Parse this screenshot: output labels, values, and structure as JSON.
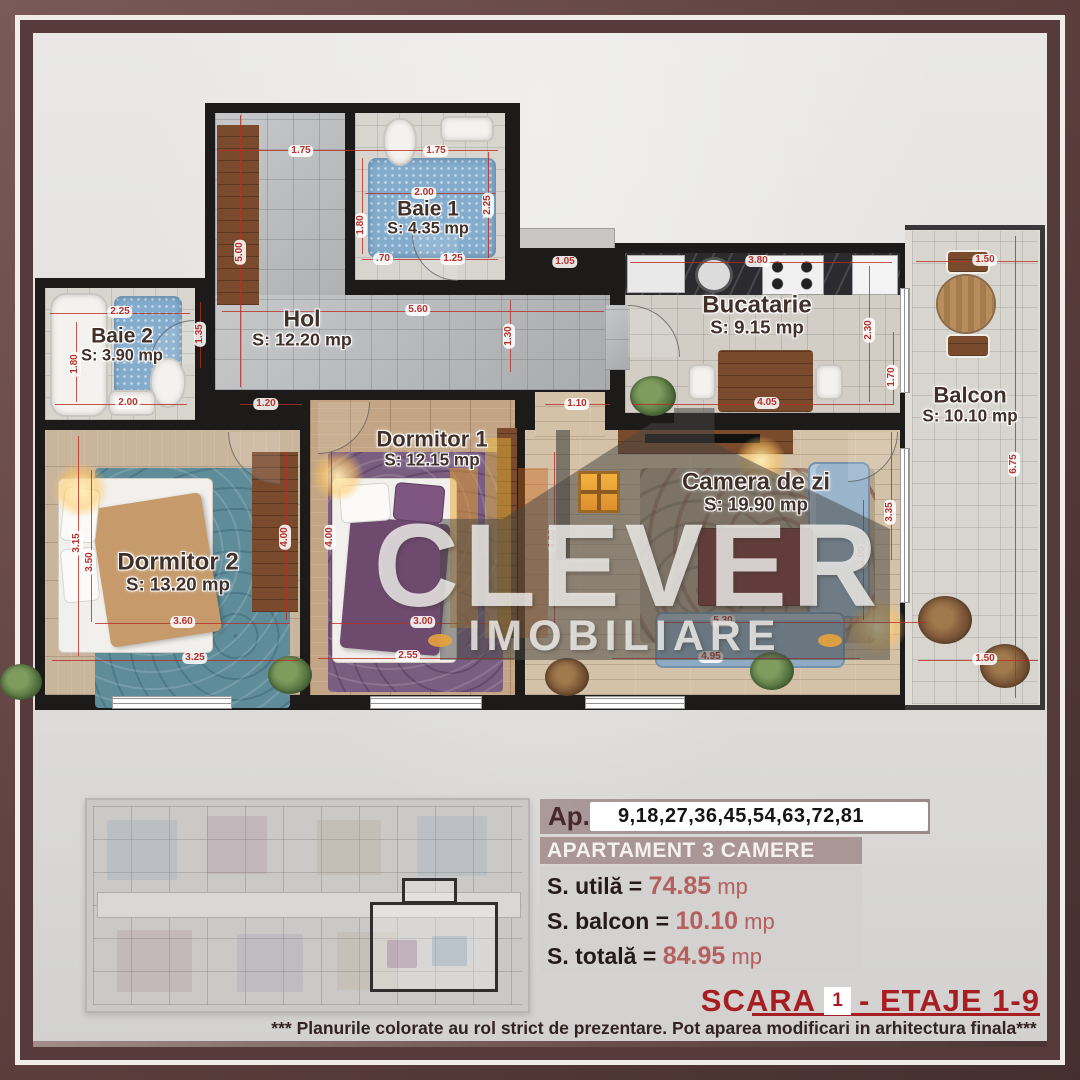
{
  "brand": {
    "name": "CLEVER",
    "tagline": "IMOBILIARE"
  },
  "plan": {
    "rooms": [
      {
        "id": "baie1",
        "name": "Baie 1",
        "area": "S: 4.35 mp",
        "x": 428,
        "y": 218,
        "fs": 21
      },
      {
        "id": "baie2",
        "name": "Baie 2",
        "area": "S: 3.90 mp",
        "x": 122,
        "y": 345,
        "fs": 21
      },
      {
        "id": "hol",
        "name": "Hol",
        "area": "S: 12.20 mp",
        "x": 302,
        "y": 328,
        "fs": 23
      },
      {
        "id": "bucatarie",
        "name": "Bucatarie",
        "area": "S: 9.15 mp",
        "x": 757,
        "y": 315,
        "fs": 24
      },
      {
        "id": "balcon",
        "name": "Balcon",
        "area": "S: 10.10 mp",
        "x": 970,
        "y": 404,
        "fs": 22
      },
      {
        "id": "dormitor1",
        "name": "Dormitor 1",
        "area": "S: 12.15 mp",
        "x": 432,
        "y": 448,
        "fs": 22
      },
      {
        "id": "dormitor2",
        "name": "Dormitor 2",
        "area": "S: 13.20 mp",
        "x": 178,
        "y": 572,
        "fs": 24
      },
      {
        "id": "camera-de-zi",
        "name": "Camera de zi",
        "area": "S: 19.90 mp",
        "x": 756,
        "y": 492,
        "fs": 24
      }
    ],
    "dimensions": [
      {
        "t": "1.75",
        "x": 301,
        "y": 151
      },
      {
        "t": "1.75",
        "x": 436,
        "y": 151
      },
      {
        "t": "2.00",
        "x": 424,
        "y": 193
      },
      {
        "t": "2.25",
        "x": 488,
        "y": 205,
        "v": 1
      },
      {
        "t": "1.80",
        "x": 361,
        "y": 225,
        "v": 1
      },
      {
        "t": ".70",
        "x": 383,
        "y": 259
      },
      {
        "t": "1.25",
        "x": 453,
        "y": 259
      },
      {
        "t": "5.00",
        "x": 240,
        "y": 252,
        "v": 1
      },
      {
        "t": "2.25",
        "x": 120,
        "y": 312
      },
      {
        "t": "1.35",
        "x": 200,
        "y": 334,
        "v": 1
      },
      {
        "t": "1.80",
        "x": 75,
        "y": 364,
        "v": 1
      },
      {
        "t": "2.00",
        "x": 128,
        "y": 403
      },
      {
        "t": "5.60",
        "x": 418,
        "y": 310
      },
      {
        "t": "1.30",
        "x": 509,
        "y": 336,
        "v": 1
      },
      {
        "t": "1.05",
        "x": 565,
        "y": 262
      },
      {
        "t": "3.80",
        "x": 758,
        "y": 261
      },
      {
        "t": "2.30",
        "x": 869,
        "y": 330,
        "v": 1
      },
      {
        "t": "1.70",
        "x": 892,
        "y": 377,
        "v": 1
      },
      {
        "t": "4.05",
        "x": 767,
        "y": 403
      },
      {
        "t": "1.50",
        "x": 985,
        "y": 260
      },
      {
        "t": "6.75",
        "x": 1014,
        "y": 464,
        "v": 1
      },
      {
        "t": "1.50",
        "x": 985,
        "y": 659
      },
      {
        "t": "1.20",
        "x": 266,
        "y": 404
      },
      {
        "t": "1.10",
        "x": 577,
        "y": 404
      },
      {
        "t": "3.15",
        "x": 77,
        "y": 543,
        "v": 1
      },
      {
        "t": "3.50",
        "x": 90,
        "y": 562,
        "v": 1
      },
      {
        "t": "4.00",
        "x": 285,
        "y": 537,
        "v": 1
      },
      {
        "t": "4.00",
        "x": 330,
        "y": 537,
        "v": 1
      },
      {
        "t": "4.00",
        "x": 553,
        "y": 539,
        "v": 1
      },
      {
        "t": "3.60",
        "x": 183,
        "y": 622
      },
      {
        "t": "3.25",
        "x": 195,
        "y": 658
      },
      {
        "t": "3.00",
        "x": 423,
        "y": 622
      },
      {
        "t": "2.55",
        "x": 408,
        "y": 656
      },
      {
        "t": "5.30",
        "x": 723,
        "y": 621
      },
      {
        "t": "4.95",
        "x": 711,
        "y": 657
      },
      {
        "t": "3.35",
        "x": 890,
        "y": 512,
        "v": 1
      },
      {
        "t": "3.00",
        "x": 862,
        "y": 556,
        "v": 1
      }
    ]
  },
  "info_panel": {
    "ap_label": "Ap.",
    "ap_numbers": "9,18,27,36,45,54,63,72,81",
    "type_label": "APARTAMENT 3 CAMERE",
    "rows": [
      {
        "label": "S. utilă = ",
        "value": "74.85",
        "unit": " mp"
      },
      {
        "label": "S. balcon = ",
        "value": "10.10",
        "unit": " mp"
      },
      {
        "label": "S. totală = ",
        "value": "84.95",
        "unit": " mp"
      }
    ]
  },
  "footer": {
    "scara_label": "SCARA",
    "scara_number": "1",
    "etaje_label": "- ETAJE 1-9",
    "disclaimer": "*** Planurile colorate au rol strict de prezentare. Pot aparea modificari in arhitectura finala***"
  },
  "colors": {
    "frame_maroon": "#573b3a",
    "accent_red": "#a71e22",
    "dim_red": "#b5332c",
    "value_red": "#b65f5f",
    "wall_black": "#1d1b19"
  }
}
